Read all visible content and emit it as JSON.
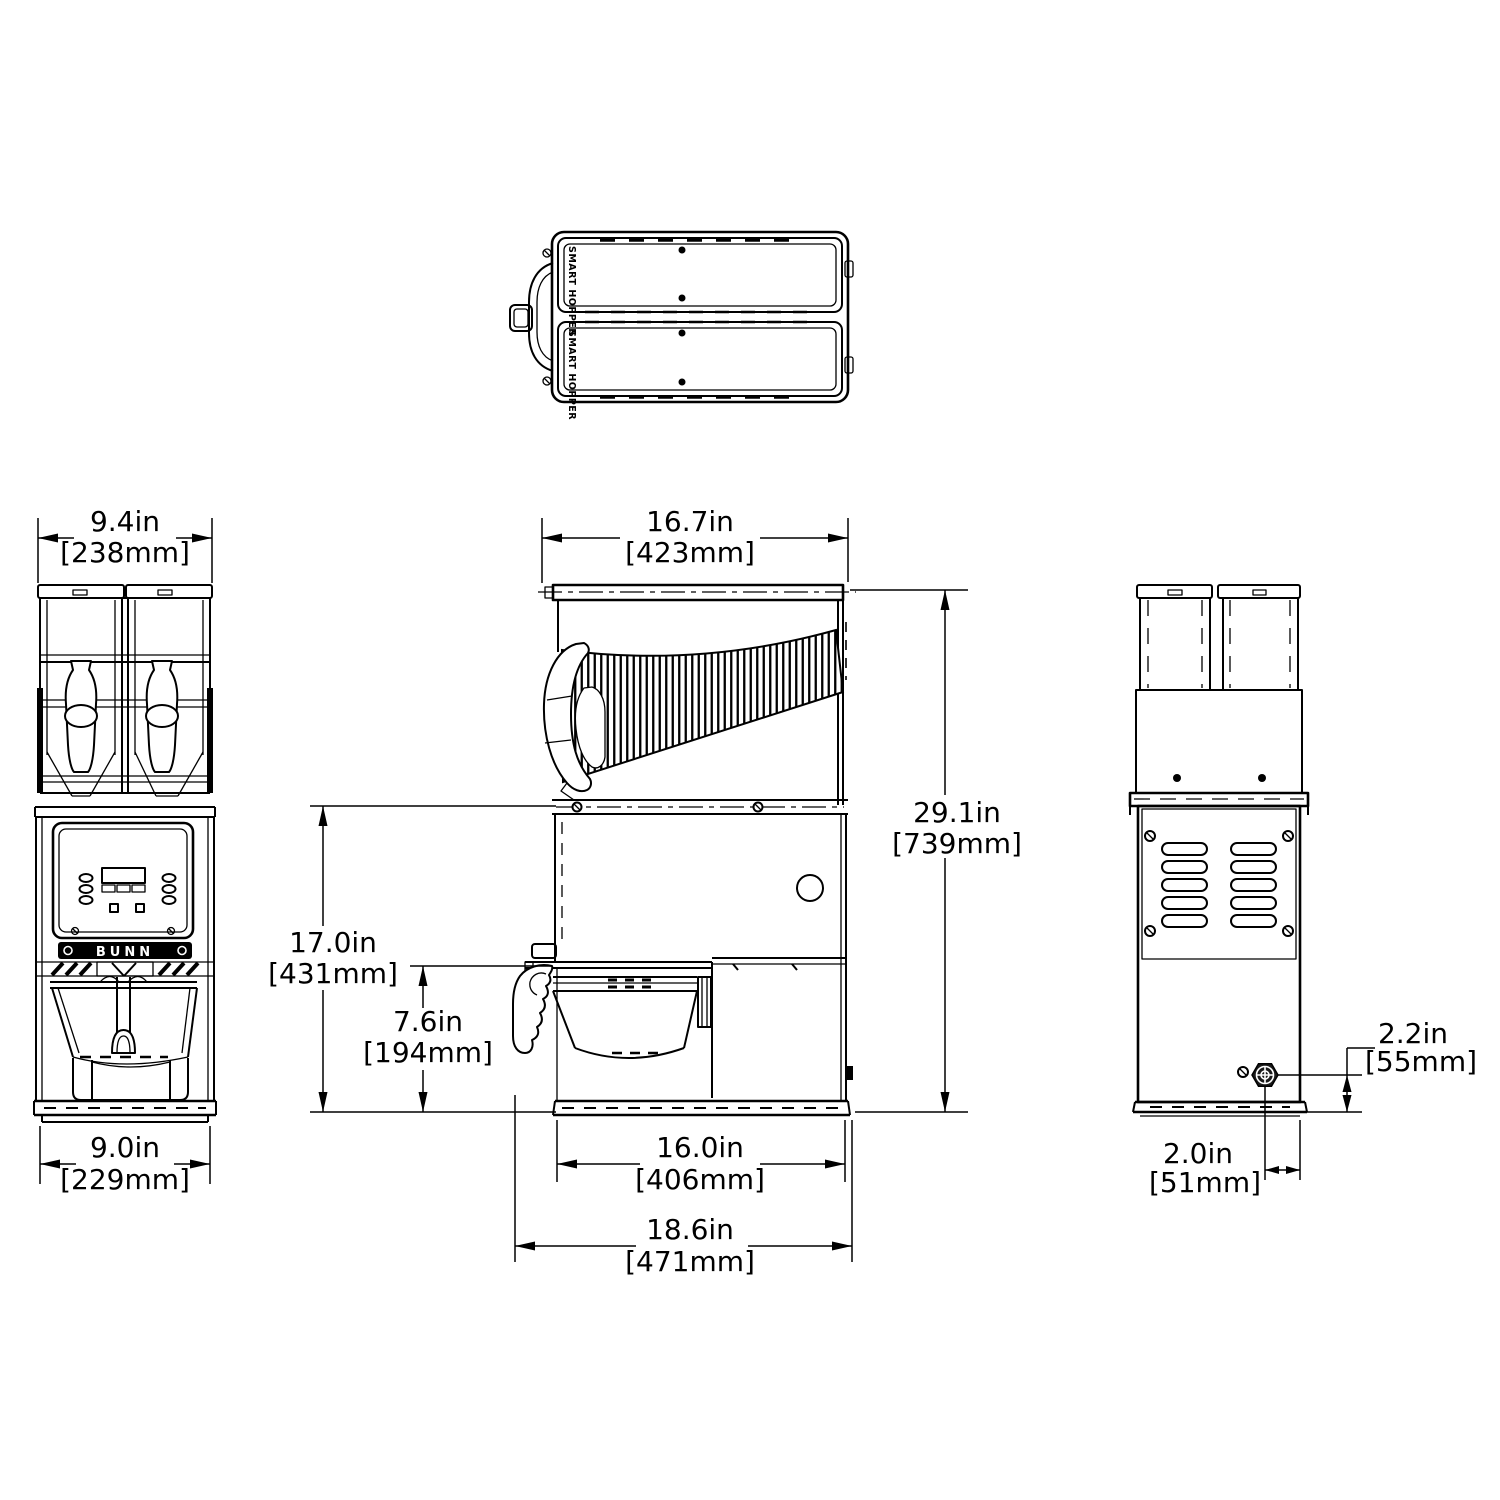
{
  "labels": {
    "brand": "BUNN",
    "hopper_lid": "SMART HOPPER"
  },
  "dimensions": {
    "front_width_top": {
      "in": "9.4in",
      "mm": "[238mm]"
    },
    "front_width_base": {
      "in": "9.0in",
      "mm": "[229mm]"
    },
    "depth_top": {
      "in": "16.7in",
      "mm": "[423mm]"
    },
    "height_overall": {
      "in": "29.1in",
      "mm": "[739mm]"
    },
    "height_to_hopper_base": {
      "in": "17.0in",
      "mm": "[431mm]"
    },
    "funnel_clearance": {
      "in": "7.6in",
      "mm": "[194mm]"
    },
    "depth_base": {
      "in": "16.0in",
      "mm": "[406mm]"
    },
    "depth_overall": {
      "in": "18.6in",
      "mm": "[471mm]"
    },
    "cord_height": {
      "in": "2.2in",
      "mm": "[55mm]"
    },
    "cord_offset": {
      "in": "2.0in",
      "mm": "[51mm]"
    }
  }
}
